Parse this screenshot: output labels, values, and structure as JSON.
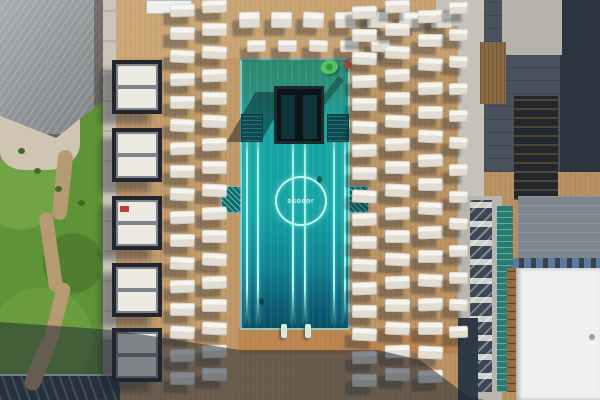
{
  "scene": {
    "description": "Aerial top-down photo of a resort pool deck: turquoise rectangular pool with glowing lane lines and circular neon brand logo, wooden deck with rows of white lounge chairs, cabana column, lawn with winding path at left, buildings and white rooftop at right, long building shadow across the bottom.",
    "time_of_day": "sunny afternoon"
  },
  "pool": {
    "logo_text": "osocor",
    "water_top_color": "#2e8a6d",
    "water_main_color": "#14a2a4",
    "water_deep_color": "#0a4c61",
    "lane_line_color": "#aef6ea",
    "lane_x": [
      246,
      257,
      292,
      304,
      333,
      344
    ],
    "ladder_x": [
      281,
      305
    ],
    "swimmers": [
      {
        "x": 317,
        "y": 176
      },
      {
        "x": 259,
        "y": 298
      }
    ],
    "floats": [
      {
        "kind": "green-ring"
      },
      {
        "kind": "red-star"
      }
    ]
  },
  "palette": {
    "deck_wood": "#c19a6a",
    "grass": "#5f9338",
    "roof_left": "#8f9396",
    "roof_right_dark": "#49525c",
    "roof_white": "#eff1f0",
    "chair_white": "#f6f4ee",
    "cabana_frame": "#22262c",
    "shadow": "rgba(28,38,52,0.52)"
  },
  "furniture": {
    "chair_groups": [
      {
        "name": "top-row-1",
        "x": 239,
        "y": 12,
        "dx": 32,
        "dy": 0,
        "count": 7,
        "w": 21,
        "h": 16
      },
      {
        "name": "top-row-2",
        "x": 247,
        "y": 40,
        "dx": 31,
        "dy": 0,
        "count": 5,
        "w": 19,
        "h": 12
      },
      {
        "name": "left-col-1",
        "x": 170,
        "y": 4,
        "dx": 0,
        "dy": 23,
        "count": 17,
        "w": 25,
        "h": 13
      },
      {
        "name": "left-col-2",
        "x": 202,
        "y": 0,
        "dx": 0,
        "dy": 23,
        "count": 17,
        "w": 25,
        "h": 13
      },
      {
        "name": "right-col-1",
        "x": 352,
        "y": 6,
        "dx": 0,
        "dy": 23,
        "count": 17,
        "w": 25,
        "h": 13
      },
      {
        "name": "right-col-2",
        "x": 385,
        "y": 0,
        "dx": 0,
        "dy": 23,
        "count": 17,
        "w": 25,
        "h": 13
      },
      {
        "name": "right-col-3",
        "x": 418,
        "y": 10,
        "dx": 0,
        "dy": 24,
        "count": 16,
        "w": 25,
        "h": 13
      },
      {
        "name": "walkway-col",
        "x": 449,
        "y": 2,
        "dx": 0,
        "dy": 27,
        "count": 13,
        "w": 19,
        "h": 12
      }
    ],
    "cabanas": {
      "x": 112,
      "w": 50,
      "h": 54,
      "ys": [
        60,
        128,
        196,
        263,
        328
      ],
      "red_pillow_indices": [
        2
      ]
    }
  },
  "landscape": {
    "path_segments": [
      {
        "x": 55,
        "y": 150,
        "w": 15,
        "h": 70,
        "rot": 6
      },
      {
        "x": 44,
        "y": 212,
        "w": 14,
        "h": 80,
        "rot": -8
      },
      {
        "x": 50,
        "y": 282,
        "w": 14,
        "h": 66,
        "rot": 14
      },
      {
        "x": 32,
        "y": 336,
        "w": 16,
        "h": 56,
        "rot": 22
      }
    ],
    "bushes": [
      {
        "x": 18,
        "y": 148
      },
      {
        "x": 34,
        "y": 168
      },
      {
        "x": 55,
        "y": 186
      },
      {
        "x": 78,
        "y": 200
      }
    ],
    "trees": [
      {
        "x": 437,
        "y": 2,
        "s": 16
      },
      {
        "x": 545,
        "y": 4,
        "s": 14
      }
    ],
    "umbrella_bits": [
      {
        "x": 470,
        "y": 385,
        "s": 8,
        "c": "#5aa04a"
      },
      {
        "x": 480,
        "y": 392,
        "s": 7,
        "c": "#d8c040"
      }
    ]
  }
}
